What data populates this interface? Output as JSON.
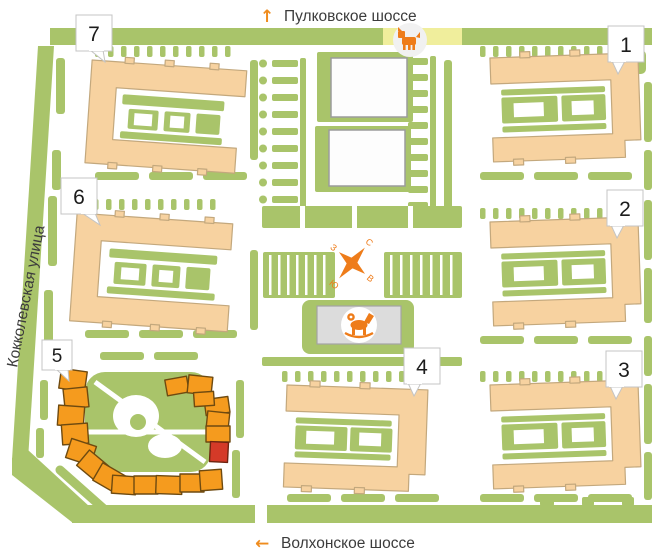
{
  "map": {
    "streets": {
      "top": {
        "direction_arrow": "↑",
        "label": "Пулковское шоссе"
      },
      "bottom": {
        "direction_arrow": "←",
        "label": "Волхонское шоссе"
      },
      "left": {
        "label": "Кокколевская улица"
      }
    },
    "buildings": [
      {
        "label": "1",
        "state": "default"
      },
      {
        "label": "2",
        "state": "default"
      },
      {
        "label": "3",
        "state": "default"
      },
      {
        "label": "4",
        "state": "default"
      },
      {
        "label": "5",
        "state": "highlighted",
        "has_selected_section": true
      },
      {
        "label": "6",
        "state": "default"
      },
      {
        "label": "7",
        "state": "default"
      }
    ],
    "compass": {
      "north": "С",
      "south": "Ю",
      "east": "В",
      "west": "З"
    },
    "icons": [
      {
        "name": "dog-walking-area-icon"
      },
      {
        "name": "playground-rocking-horse-icon"
      }
    ],
    "colors": {
      "lawn_green": "#a9c46a",
      "building_peach": "#f7d2a0",
      "highlight_orange": "#f59b1e",
      "selected_red": "#d43a28",
      "accent_orange": "#ef8c1e",
      "dog_area_yellow": "#f0ee9c",
      "service_building_gray": "#dcdcdc"
    }
  }
}
